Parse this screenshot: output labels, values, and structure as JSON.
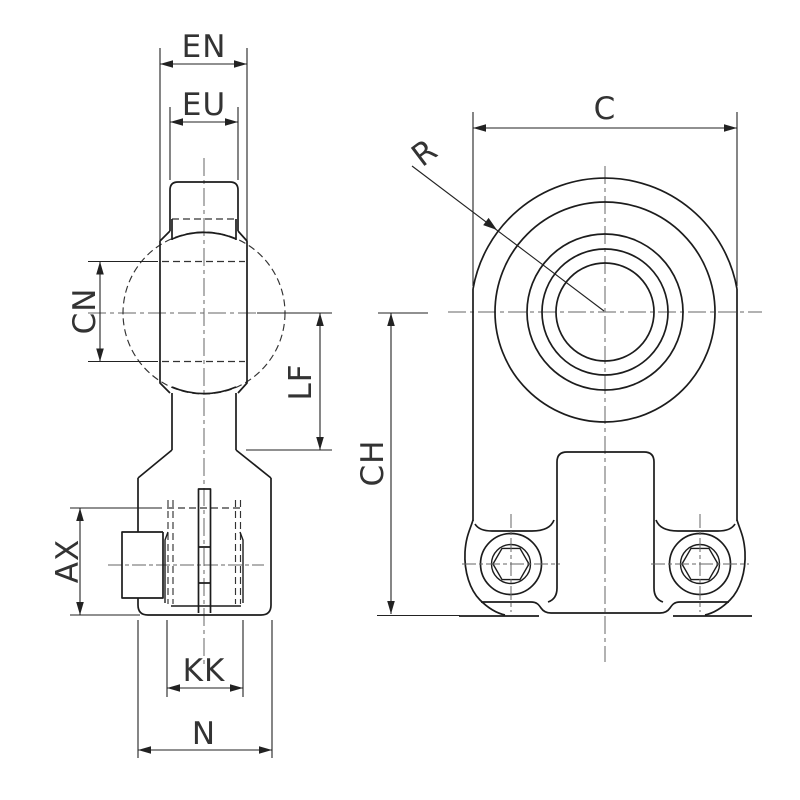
{
  "drawing_type": "technical-dimension-drawing",
  "labels": {
    "en": "EN",
    "eu": "EU",
    "cn": "CN",
    "lf": "LF",
    "ax": "AX",
    "kk": "KK",
    "n": "N",
    "c": "C",
    "r": "R",
    "ch": "CH"
  },
  "colors": {
    "background": "#ffffff",
    "outline": "#1c1c1c",
    "dimension": "#222222",
    "centerline": "#666666",
    "hidden": "#333333",
    "text": "#333333"
  }
}
